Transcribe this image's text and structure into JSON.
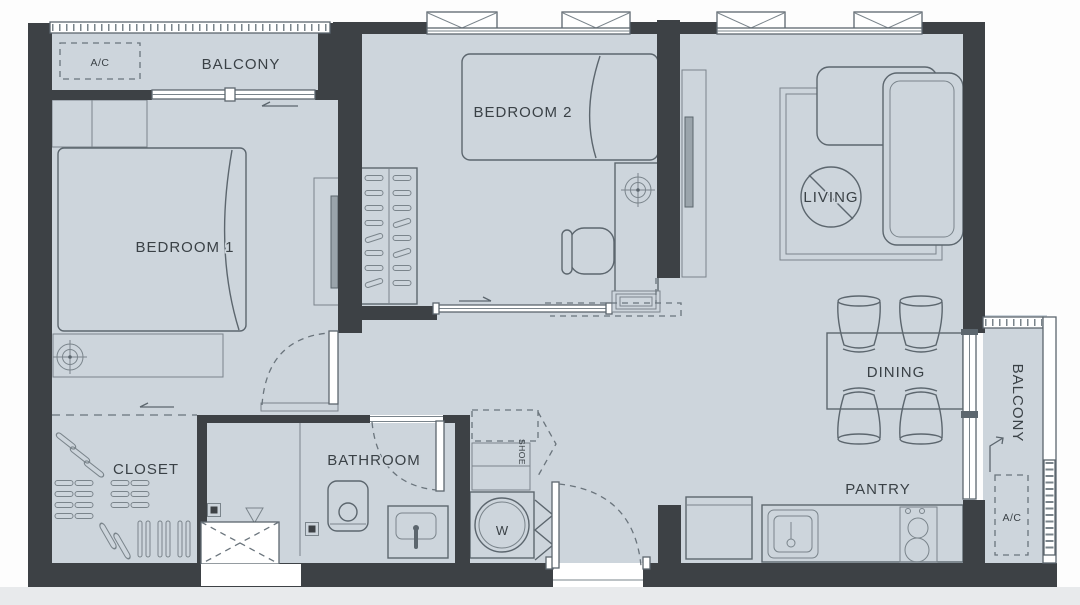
{
  "plan": {
    "rooms": {
      "balcony_top": "BALCONY",
      "bedroom_2": "BEDROOM 2",
      "living": "LIVING",
      "bedroom_1": "BEDROOM 1",
      "dining": "DINING",
      "closet": "CLOSET",
      "bathroom": "BATHROOM",
      "pantry": "PANTRY",
      "balcony_right": "BALCONY"
    },
    "equipment": {
      "ac_top": "A/C",
      "ac_right": "A/C",
      "shoe_cabinet": "SHOE",
      "washer": "W"
    },
    "colors": {
      "floor": "#cdd5dc",
      "wall": "#3d4145",
      "furniture_line": "#5c666e",
      "light_line": "#8a949b",
      "label_text": "#3a4146",
      "page_bottom_strip": "#e8eaec"
    }
  }
}
